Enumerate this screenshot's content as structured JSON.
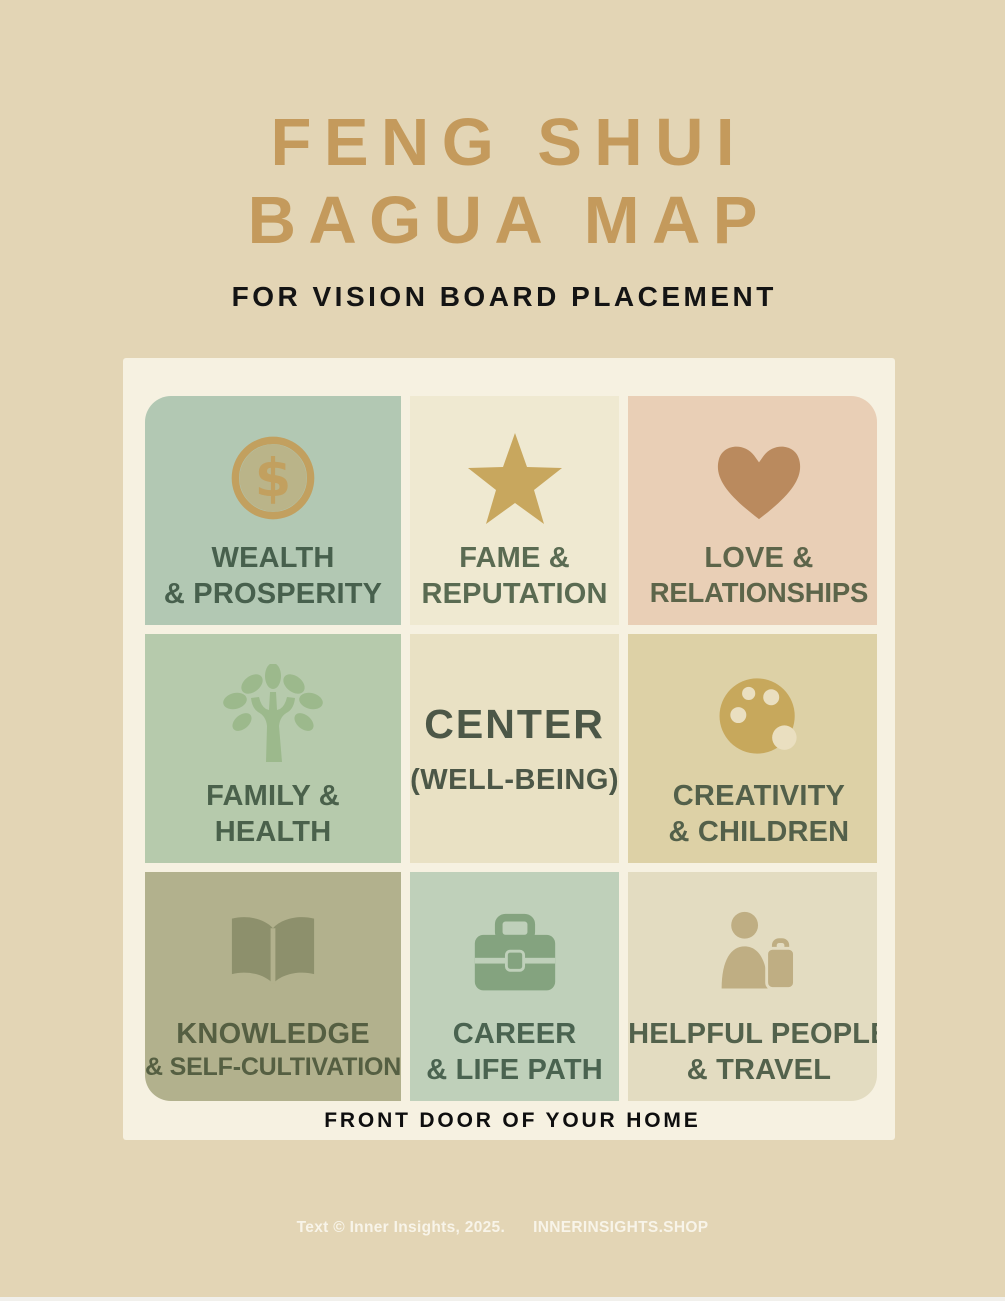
{
  "page": {
    "background": "#e3d5b5",
    "title_line1": "FENG SHUI",
    "title_line2": "BAGUA MAP",
    "title_color": "#c49a5c",
    "subtitle": "FOR VISION BOARD PLACEMENT"
  },
  "bagua": {
    "card_background": "#f6f1e1",
    "front_door_label": "FRONT DOOR OF YOUR HOME",
    "cells": [
      {
        "id": "wealth-prosperity",
        "icon": "dollar-coin-icon",
        "lines": [
          "WEALTH",
          "& PROSPERITY"
        ],
        "bg": "#b2c8b3",
        "icon_color": "#c2a05f",
        "text_color": "#47604d"
      },
      {
        "id": "fame-reputation",
        "icon": "star-icon",
        "lines": [
          "FAME &",
          "REPUTATION"
        ],
        "bg": "#efe9d1",
        "icon_color": "#c8a75e",
        "text_color": "#5a6b52"
      },
      {
        "id": "love-relationships",
        "icon": "heart-icon",
        "lines": [
          "LOVE &",
          "RELATIONSHIPS"
        ],
        "bg": "#e9cfb6",
        "icon_color": "#ba8a5e",
        "text_color": "#5d654a"
      },
      {
        "id": "family-health",
        "icon": "tree-icon",
        "lines": [
          "FAMILY &",
          "HEALTH"
        ],
        "bg": "#b6caac",
        "icon_color": "#9cb98c",
        "text_color": "#4a614b"
      },
      {
        "id": "center",
        "icon": null,
        "lines": [
          "CENTER",
          "(WELL-BEING)"
        ],
        "bg": "#e9e1c4",
        "icon_color": null,
        "text_color": "#4c5747"
      },
      {
        "id": "creativity-children",
        "icon": "paint-palette-icon",
        "lines": [
          "CREATIVITY",
          "& CHILDREN"
        ],
        "bg": "#ddd1a6",
        "icon_color": "#c7a85c",
        "hole_color": "#eadfc0",
        "text_color": "#53604a"
      },
      {
        "id": "knowledge-self-cultivation",
        "icon": "open-book-icon",
        "lines": [
          "KNOWLEDGE",
          "& SELF-CULTIVATION"
        ],
        "bg": "#b2b18d",
        "icon_color": "#8d906c",
        "hole_color": "#b2b18d",
        "text_color": "#555f42"
      },
      {
        "id": "career-life-path",
        "icon": "briefcase-icon",
        "lines": [
          "CAREER",
          "& LIFE PATH"
        ],
        "bg": "#bfd0ba",
        "icon_color": "#84a37f",
        "hole_color": "#bfd0ba",
        "text_color": "#4a6350"
      },
      {
        "id": "helpful-people-travel",
        "icon": "person-luggage-icon",
        "lines": [
          "HELPFUL PEOPLE",
          "& TRAVEL"
        ],
        "bg": "#e3dcc1",
        "icon_color": "#bfae83",
        "hole_color": "#e3dcc1",
        "text_color": "#53624c"
      }
    ]
  },
  "footer": {
    "copyright": "Text © Inner Insights, 2025.",
    "website": "INNERINSIGHTS.SHOP",
    "text_color": "#f8f4e9"
  }
}
